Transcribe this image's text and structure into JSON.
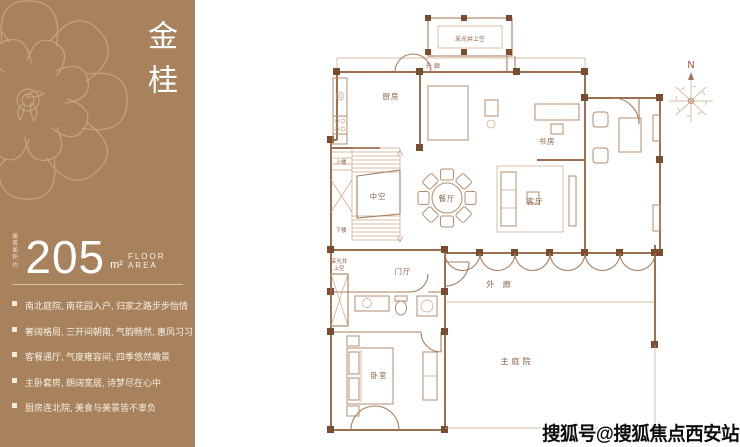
{
  "sidebar": {
    "bg_color": "#a8825d",
    "title": "金桂",
    "area": {
      "prefix": [
        "建筑",
        "面积",
        "约"
      ],
      "value": "205",
      "unit": "m²",
      "label": "FLOOR AREA"
    },
    "features": [
      {
        "text": "南北庭院, 南花园入户, 归家之路步步怡情"
      },
      {
        "text": "奢阔格局, 三开间朝南, 气韵畅然, 惠风习习"
      },
      {
        "text": "客餐通厅, 气度雍容间, 四季悠然瞰景"
      },
      {
        "text": "主卧套房, 朗阔宽居, 诗梦尽在心中"
      },
      {
        "text": "厨房连北院, 美食与美景皆不辜负"
      }
    ]
  },
  "floorplan": {
    "line_color": "#a87e5f",
    "column_color": "#7a4c30",
    "labels": {
      "light_well_top": "采光井上空",
      "outer_corridor_top": "外 廊",
      "kitchen": "厨房",
      "study": "书房",
      "dining": "餐厅",
      "living": "客厅",
      "void": "中空",
      "stairs_up": "上楼",
      "stairs_down": "下楼",
      "light_well_left_1": "采光井",
      "light_well_left_2": "上空",
      "foyer": "门厅",
      "outer_corridor_right": "外 廊",
      "bedroom": "卧室",
      "main_courtyard": "主庭院"
    },
    "compass": {
      "label": "N"
    }
  },
  "watermark": {
    "text": "搜狐号@搜狐焦点西安站"
  }
}
